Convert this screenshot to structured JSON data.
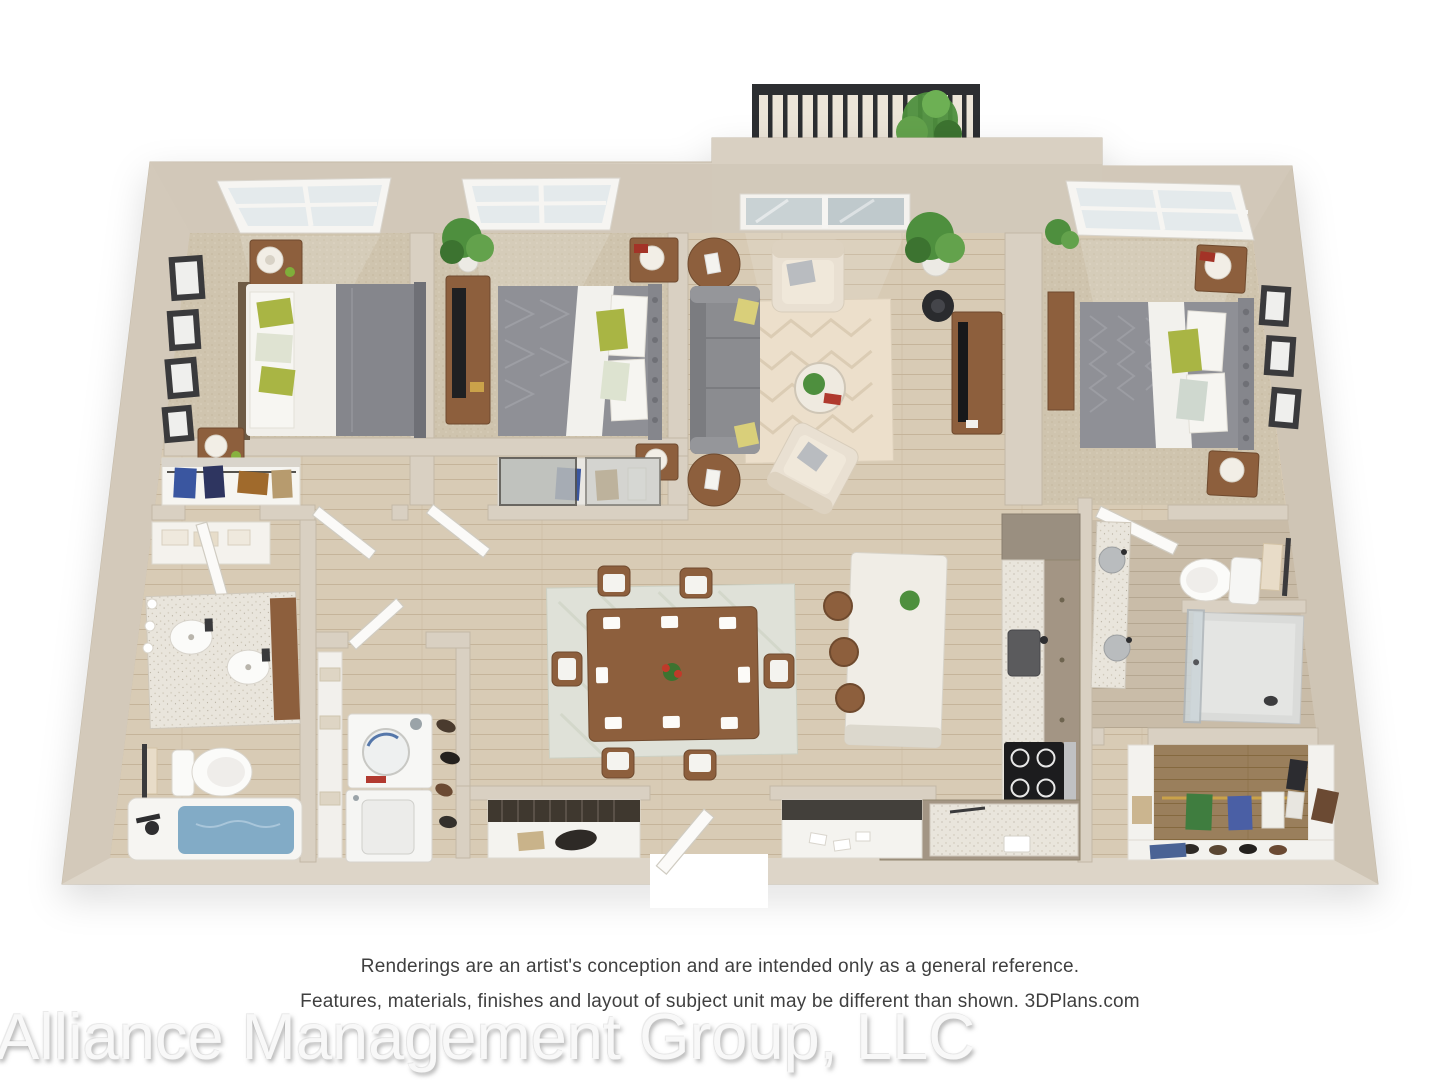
{
  "page": {
    "background": "#ffffff"
  },
  "palette": {
    "wall": "#d9d0c2",
    "wall_face": "#d2c8b9",
    "wall_edge": "#c3b8a6",
    "wood": "#d8cbb5",
    "wood_line": "#c5b49a",
    "carpet": "#cfc4ae",
    "wood_dark": "#9a7f5c",
    "wood_gray": "#c9bca8",
    "glass": "#c9d2d4",
    "railing": "#2c2e31",
    "sofa": "#8b8c90",
    "bed_gray": "#8f9096",
    "duvet_white": "#f1efea",
    "green_accent": "#a9b544",
    "plant_green": "#4e8f3e",
    "furniture_wood": "#8d5f3d",
    "tub_water": "#82abc6",
    "counter_speckle": "#e9e5dc",
    "cabinet_taupe": "#a39584",
    "appliance_black": "#1c1c1e",
    "living_rug": "#ecdfcb",
    "dining_rug": "#dfe1d8",
    "text_gray": "#3f3f3f",
    "watermark_gray": "#f8f8f8"
  },
  "footer": {
    "disclaimer_line1": "Renderings are an artist's conception and are intended only as a general reference.",
    "disclaimer_line2": "Features, materials, finishes and layout of subject unit may be different than shown. 3DPlans.com",
    "watermark": "Alliance Management Group, LLC"
  },
  "floorplan": {
    "type": "3d-rendered-floor-plan",
    "view": "top-down dollhouse rendering",
    "rooms": [
      {
        "name": "bedroom-left",
        "features": [
          "window",
          "queen bed with white duvet, gray throw and green accent pillows",
          "two wood nightstands with white lamps",
          "gallery wall of four frames",
          "reach-in closet with hanging clothes"
        ]
      },
      {
        "name": "bedroom-middle",
        "features": [
          "window",
          "tall potted plant",
          "dresser with television",
          "queen bed with gray duvet and green accent pillow",
          "nightstands with lamps",
          "sliding-door closet"
        ]
      },
      {
        "name": "living-room",
        "features": [
          "balcony with black metal railing and plant",
          "sliding glass door",
          "gray sofa with accent pillows",
          "two cream accent chairs",
          "two round wood side tables",
          "herringbone area rug",
          "round coffee table with plant",
          "media console with television and speaker"
        ]
      },
      {
        "name": "bedroom-right",
        "features": [
          "window",
          "queen bed with patterned gray duvet and green accent pillow",
          "two wood nightstands with white lamps",
          "dresser",
          "three wall frames"
        ]
      },
      {
        "name": "bathroom-left",
        "features": [
          "linen closet with towels",
          "double-sink vanity",
          "toilet",
          "bathtub with filled water",
          "towel bar"
        ]
      },
      {
        "name": "laundry-room",
        "features": [
          "stacked washer and dryer",
          "linen shelving",
          "shoe storage"
        ]
      },
      {
        "name": "dining-area",
        "features": [
          "rectangular wood table",
          "six chairs with white cushions",
          "patterned area rug",
          "red centerpiece"
        ]
      },
      {
        "name": "kitchen",
        "features": [
          "quartz island with plant",
          "three round stools",
          "L-shaped counters",
          "undermount sink",
          "four-burner cooktop",
          "tall cabinet"
        ]
      },
      {
        "name": "bathroom-right",
        "features": [
          "vanity with two sinks",
          "toilet",
          "towel bar",
          "glass walk-in shower"
        ]
      },
      {
        "name": "walk-in-closet",
        "features": [
          "hanging clothes",
          "shoe shelves",
          "jeans stack",
          "storage boxes",
          "bag"
        ]
      },
      {
        "name": "entry-foyer",
        "features": [
          "front door",
          "two storage closets with shelving"
        ]
      }
    ]
  }
}
